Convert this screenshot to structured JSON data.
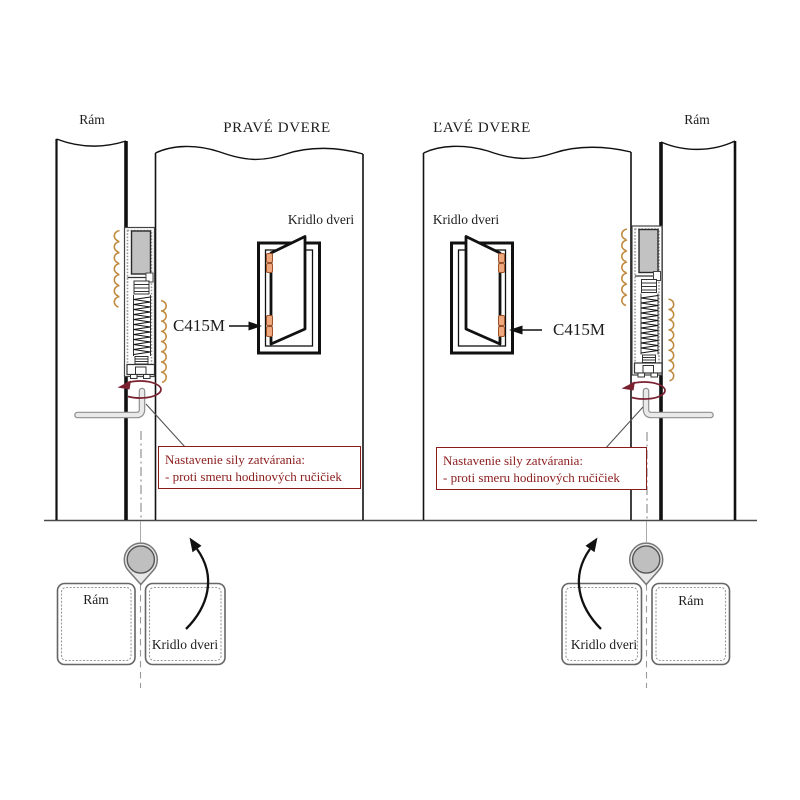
{
  "diagrams": {
    "top_left": {
      "frame_label": "Rám",
      "title": "PRAVÉ DVERE",
      "leaf_label": "Kridlo dveri",
      "model_label": "C415M"
    },
    "top_right": {
      "frame_label": "Rám",
      "title": "ĽAVÉ DVERE",
      "leaf_label": "Kridlo dveri",
      "model_label": "C415M"
    },
    "bottom_left": {
      "frame_label": "Rám",
      "leaf_label": "Kridlo dveri"
    },
    "bottom_right": {
      "frame_label": "Rám",
      "leaf_label": "Kridlo dveri"
    }
  },
  "adjustment_note": {
    "line1": "Nastavenie sily zatvárania:",
    "line2": "- proti smeru hodinových ručičiek"
  },
  "colors": {
    "note_red": "#8b1c1c",
    "rotation_arrow_red": "#7a2130",
    "spring_hook_tan": "#c08a3e",
    "hinge_orange": "#efa87d",
    "metal_gray": "#c2c2c2",
    "line_dark": "#111111"
  }
}
